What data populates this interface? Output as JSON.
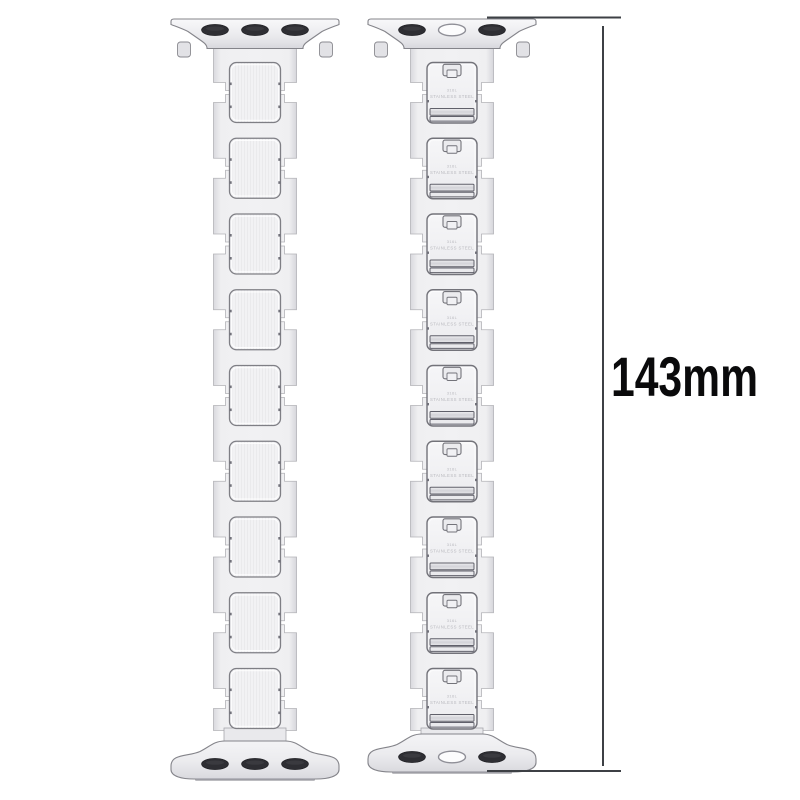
{
  "canvas": {
    "width": 800,
    "height": 800,
    "background": "#ffffff"
  },
  "dimension": {
    "label": "143mm",
    "value_mm": 143
  },
  "bands": [
    {
      "id": "band-front",
      "view": "front",
      "link_count": 9,
      "top_adapter": {
        "slots": [
          "dark",
          "dark",
          "dark"
        ]
      },
      "bottom_adapter": {
        "slots": [
          "dark",
          "dark",
          "dark"
        ]
      }
    },
    {
      "id": "band-back",
      "view": "back",
      "link_count": 9,
      "engraving": [
        "316L",
        "STAINLESS STEEL"
      ],
      "top_adapter": {
        "slots": [
          "dark",
          "light",
          "dark"
        ]
      },
      "bottom_adapter": {
        "slots": [
          "dark",
          "light",
          "dark"
        ]
      }
    }
  ],
  "colors": {
    "background": "#ffffff",
    "metal_light": "#f2f2f4",
    "metal_mid": "#ececef",
    "metal_edge": "#d8d8dd",
    "outline": "#84848a",
    "outline_dark": "#60606a",
    "slot_dark": "#2e2e33",
    "slot_light": "#fcfcfd",
    "engraving": "#b9b9bf",
    "dimension_line": "#3d4045",
    "label_text": "#0a0a0b"
  }
}
